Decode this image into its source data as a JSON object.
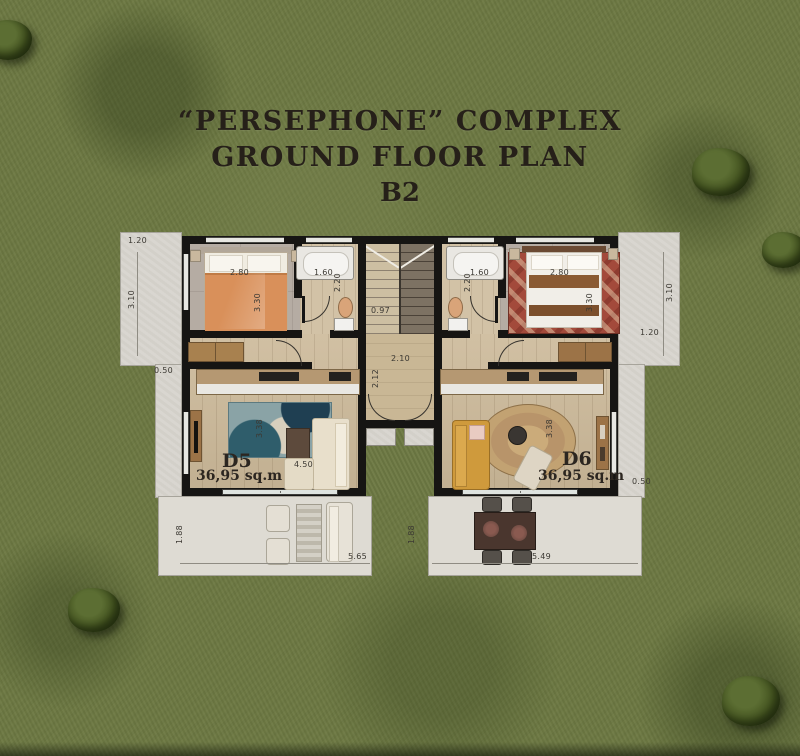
{
  "title": {
    "line1": "“PERSEPHONE” COMPLEX",
    "line2": "GROUND FLOOR PLAN",
    "line3": "B2"
  },
  "units": {
    "d5": {
      "name": "D5",
      "area": "36,95 sq.m"
    },
    "d6": {
      "name": "D6",
      "area": "36,95 sq.m"
    }
  },
  "dimensions": {
    "left_path_top_width": "1.20",
    "left_path_length": "3.10",
    "left_path_narrow": "0.50",
    "bedroom_left_width": "2.80",
    "bedroom_left_depth": "3.30",
    "bath_left_width": "1.60",
    "bath_left_depth": "2.20",
    "stair_width": "0.97",
    "hall_width": "2.10",
    "hall_depth": "2.12",
    "bath_right_width": "1.60",
    "bath_right_depth": "2.20",
    "bedroom_right_width": "2.80",
    "bedroom_right_depth": "3.30",
    "right_path_length": "3.10",
    "right_path_top_width": "1.20",
    "right_path_narrow": "0.50",
    "living_left_width": "4.50",
    "living_left_depth": "3.38",
    "living_right_depth": "3.38",
    "patio_left_depth": "1.88",
    "patio_left_width": "5.65",
    "patio_right_depth": "1.88",
    "patio_right_width": "5.49"
  },
  "colors": {
    "grass": "#6d7943",
    "path_concrete": "#d8d5ce",
    "wall": "#161513",
    "wood_floor": "#ccb999",
    "bed_orange": "#d9905a",
    "sofa_mustard": "#cf9a3c",
    "rug_teal": "#49707c",
    "rug_red": "#a34a3b",
    "rug_jute": "#c2a272",
    "furniture_wood": "#9c7347",
    "title_text": "#262019"
  }
}
